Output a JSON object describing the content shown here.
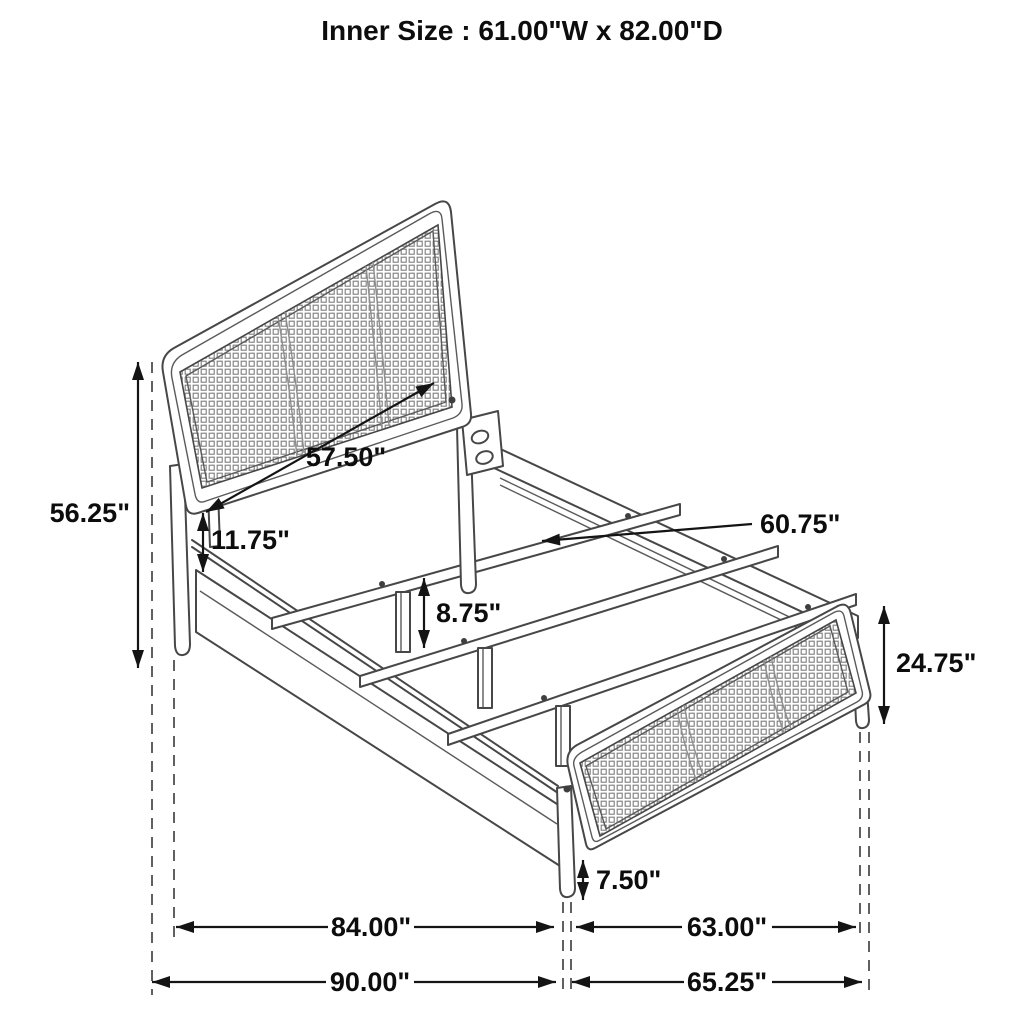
{
  "title": "Inner Size : 61.00\"W x 82.00\"D",
  "figure": {
    "type": "line-drawing",
    "subject": "bed frame with cane headboard and footboard, side rails and three slats with center support legs"
  },
  "dimensions": {
    "headboard_height": "56.25\"",
    "headboard_width": "57.50\"",
    "side_rail_height": "11.75\"",
    "center_leg_height": "8.75\"",
    "slat_length": "60.75\"",
    "footboard_height": "24.75\"",
    "footboard_leg_height": "7.50\"",
    "rail_span_length": "84.00\"",
    "footboard_inner_width": "63.00\"",
    "overall_length": "90.00\"",
    "footboard_overall_width": "65.25\""
  },
  "style": {
    "background": "#ffffff",
    "line_color": "#474747",
    "dimension_color": "#141414",
    "mesh_color": "#7d7d7d"
  }
}
